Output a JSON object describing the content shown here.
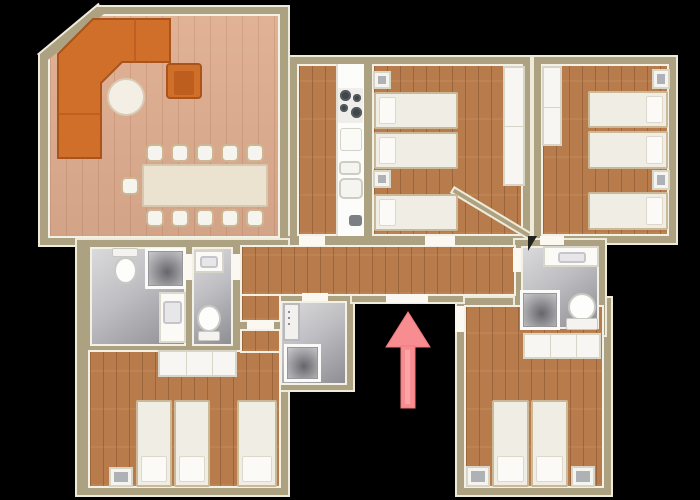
{
  "meta": {
    "type": "apartment-floor-plan",
    "width_px": 700,
    "height_px": 500,
    "background": "#000000"
  },
  "palette": {
    "wall": "#aca281",
    "wall_edge_cream": "#efebdb",
    "living_floor_wood": "#deac8e",
    "main_floor_wood": "#b87c4c",
    "bathroom_floor_gray": "#bebec2",
    "furniture_white": "#f0ede4",
    "sofa_orange": "#cf6f2a",
    "entrance_arrow_pink": "#f78d90"
  },
  "rooms": [
    {
      "id": "living-dining-room",
      "position": "top-left",
      "floor": "light wood",
      "shape": "chamfered top-left corner",
      "furniture": [
        "corner-sofa-orange",
        "orange-armchair",
        "round-coffee-table",
        "dining-table",
        "eleven-dining-chairs"
      ]
    },
    {
      "id": "kitchen",
      "position": "top-center",
      "floor": "wood",
      "furniture": [
        "kitchen-counter",
        "stove-four-burners",
        "double-sink",
        "faucet"
      ]
    },
    {
      "id": "bedroom-center",
      "position": "top-center-right",
      "floor": "wood",
      "furniture": [
        "single-bed",
        "single-bed",
        "single-bed",
        "nightstand",
        "nightstand",
        "wardrobe"
      ]
    },
    {
      "id": "bedroom-top-right",
      "position": "top-right",
      "floor": "wood",
      "furniture": [
        "single-bed",
        "single-bed",
        "single-bed",
        "nightstand",
        "nightstand",
        "wardrobe"
      ]
    },
    {
      "id": "bathroom-left-large",
      "position": "mid-left",
      "floor": "gray tile",
      "furniture": [
        "toilet",
        "shower",
        "washbasin-counter"
      ]
    },
    {
      "id": "bathroom-left-small",
      "position": "mid-left",
      "floor": "gray tile",
      "furniture": [
        "washbasin",
        "toilet"
      ]
    },
    {
      "id": "shower-room-center",
      "position": "center",
      "floor": "gray tile",
      "furniture": [
        "water-heater",
        "shower"
      ]
    },
    {
      "id": "bathroom-right",
      "position": "mid-right",
      "floor": "gray tile",
      "furniture": [
        "washbasin-counter",
        "shower",
        "toilet"
      ]
    },
    {
      "id": "bedroom-bottom-left",
      "position": "bottom-left",
      "floor": "wood",
      "furniture": [
        "single-bed",
        "single-bed",
        "single-bed",
        "wardrobe",
        "nightstand"
      ]
    },
    {
      "id": "bedroom-bottom-right",
      "position": "bottom-right",
      "floor": "wood",
      "furniture": [
        "single-bed",
        "single-bed",
        "dresser",
        "nightstand",
        "nightstand"
      ]
    },
    {
      "id": "hallway",
      "position": "center",
      "floor": "wood",
      "furniture": []
    }
  ],
  "entrance": {
    "indicator": "up-arrow",
    "color": "#f78d90",
    "position": "bottom-center",
    "meaning": "entrance direction"
  }
}
